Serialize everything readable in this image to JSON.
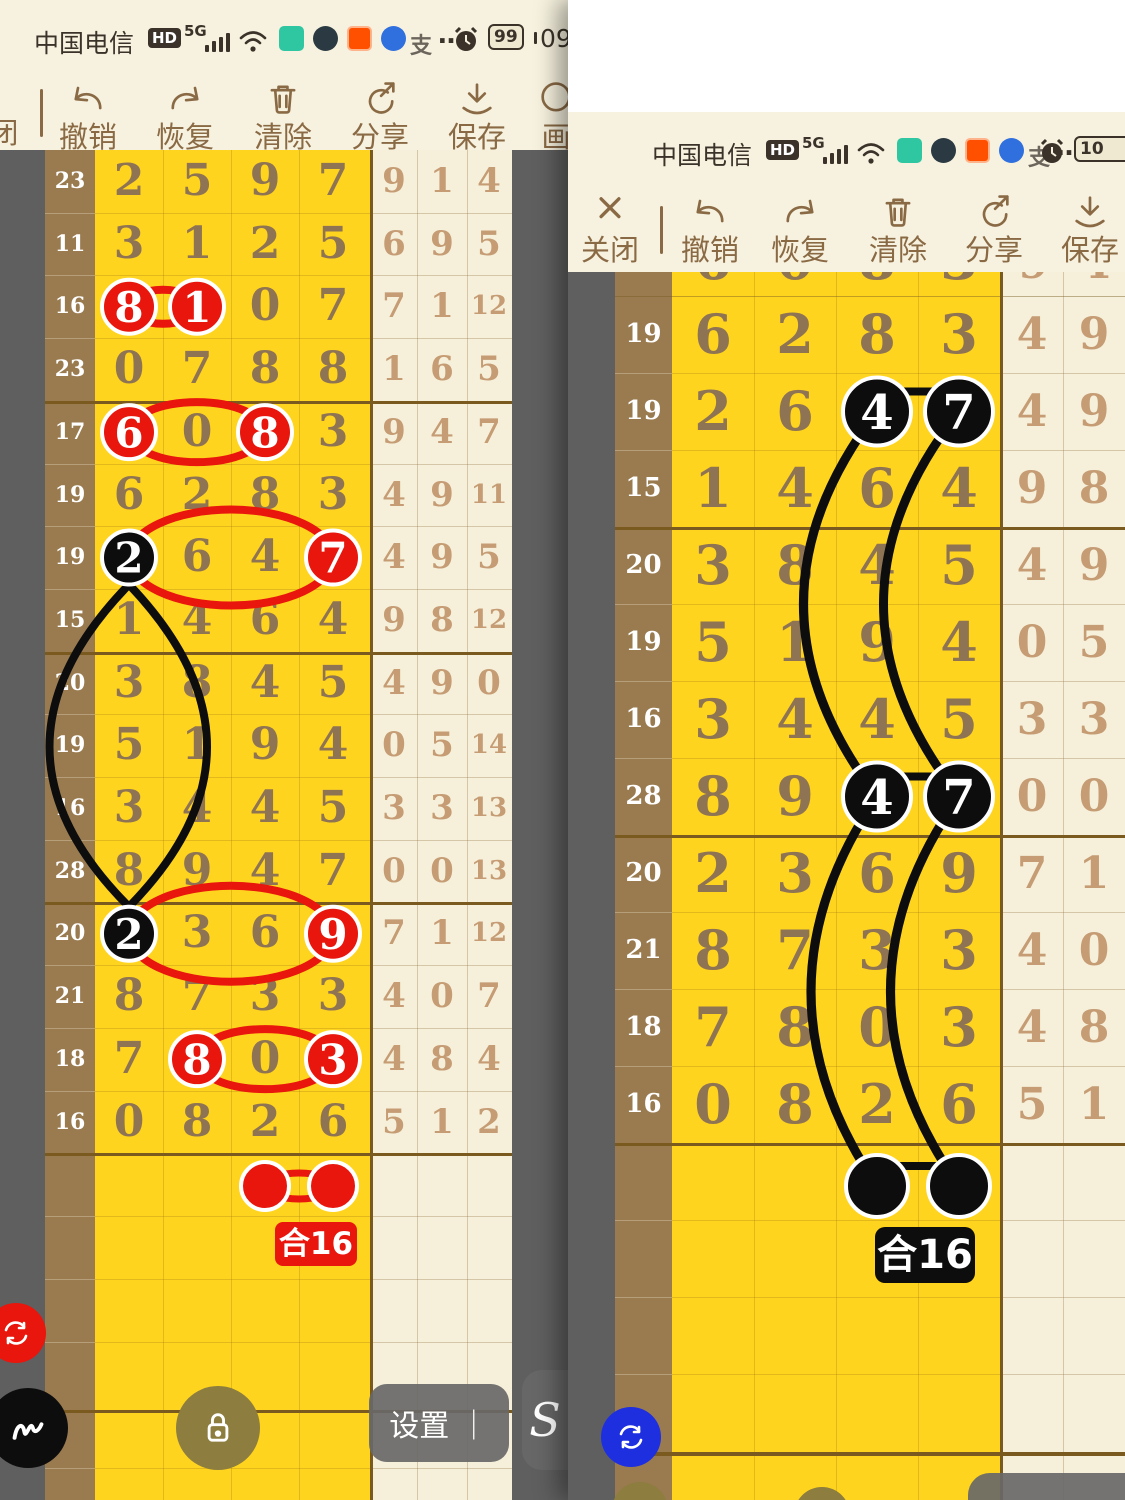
{
  "left_panel": {
    "status": {
      "carrier": "中国电信",
      "hd": "HD",
      "net": "5G",
      "alipay": "支",
      "more": "…",
      "battery": "99",
      "time": "09:"
    },
    "toolbar": {
      "close": "闭",
      "undo": "撤销",
      "redo": "恢复",
      "clear": "清除",
      "share": "分享",
      "save": "保存",
      "draw": "画"
    },
    "chart": {
      "row_labels": [
        "23",
        "11",
        "16",
        "23",
        "17",
        "19",
        "19",
        "15",
        "20",
        "19",
        "16",
        "28",
        "20",
        "21",
        "18",
        "16"
      ],
      "main_digits": [
        [
          "2",
          "5",
          "9",
          "7"
        ],
        [
          "3",
          "1",
          "2",
          "5"
        ],
        [
          "8",
          "1",
          "0",
          "7"
        ],
        [
          "0",
          "7",
          "8",
          "8"
        ],
        [
          "6",
          "0",
          "8",
          "3"
        ],
        [
          "6",
          "2",
          "8",
          "3"
        ],
        [
          "2",
          "6",
          "4",
          "7"
        ],
        [
          "1",
          "4",
          "6",
          "4"
        ],
        [
          "3",
          "8",
          "4",
          "5"
        ],
        [
          "5",
          "1",
          "9",
          "4"
        ],
        [
          "3",
          "4",
          "4",
          "5"
        ],
        [
          "8",
          "9",
          "4",
          "7"
        ],
        [
          "2",
          "3",
          "6",
          "9"
        ],
        [
          "8",
          "7",
          "3",
          "3"
        ],
        [
          "7",
          "8",
          "0",
          "3"
        ],
        [
          "0",
          "8",
          "2",
          "6"
        ]
      ],
      "right_digits": [
        [
          "9",
          "1",
          "4"
        ],
        [
          "6",
          "9",
          "5"
        ],
        [
          "7",
          "1",
          "12"
        ],
        [
          "1",
          "6",
          "5"
        ],
        [
          "9",
          "4",
          "7"
        ],
        [
          "4",
          "9",
          "11"
        ],
        [
          "4",
          "9",
          "5"
        ],
        [
          "9",
          "8",
          "12"
        ],
        [
          "4",
          "9",
          "0"
        ],
        [
          "0",
          "5",
          "14"
        ],
        [
          "3",
          "3",
          "13"
        ],
        [
          "0",
          "0",
          "13"
        ],
        [
          "7",
          "1",
          "12"
        ],
        [
          "4",
          "0",
          "7"
        ],
        [
          "4",
          "8",
          "4"
        ],
        [
          "5",
          "1",
          "2"
        ]
      ],
      "red_circles": [
        {
          "row": 2,
          "col": 0,
          "digit": "8"
        },
        {
          "row": 2,
          "col": 1,
          "digit": "1"
        },
        {
          "row": 4,
          "col": 0,
          "digit": "6"
        },
        {
          "row": 4,
          "col": 2,
          "digit": "8"
        },
        {
          "row": 6,
          "col": 3,
          "digit": "7"
        },
        {
          "row": 12,
          "col": 3,
          "digit": "9"
        },
        {
          "row": 14,
          "col": 1,
          "digit": "8"
        },
        {
          "row": 14,
          "col": 3,
          "digit": "3"
        }
      ],
      "black_circles": [
        {
          "row": 6,
          "col": 0,
          "digit": "2"
        },
        {
          "row": 12,
          "col": 0,
          "digit": "2"
        }
      ],
      "red_links": [
        {
          "row": 2,
          "c1": 0,
          "c2": 1
        },
        {
          "row": 4,
          "c1": 0,
          "c2": 2
        },
        {
          "row": 6,
          "c1": 0,
          "c2": 3
        },
        {
          "row": 12,
          "c1": 0,
          "c2": 3
        },
        {
          "row": 14,
          "c1": 1,
          "c2": 3
        }
      ],
      "black_link": {
        "col": 0,
        "r1": 6,
        "r2": 12
      },
      "prediction": {
        "cols": [
          2,
          3
        ],
        "sum_label": "合16"
      }
    },
    "fabs": {
      "settings": "设置 ｜",
      "pen_s": "S"
    }
  },
  "right_panel": {
    "status": {
      "carrier": "中国电信",
      "hd": "HD",
      "net": "5G",
      "alipay": "支",
      "more": "…",
      "battery": "10"
    },
    "toolbar": {
      "close": "关闭",
      "undo": "撤销",
      "redo": "恢复",
      "clear": "清除",
      "share": "分享",
      "save": "保存"
    },
    "chart": {
      "partial_top": {
        "main": [
          "6",
          "0",
          "8",
          "3"
        ],
        "right": [
          "9",
          "4"
        ]
      },
      "row_labels": [
        "19",
        "19",
        "15",
        "20",
        "19",
        "16",
        "28",
        "20",
        "21",
        "18",
        "16"
      ],
      "main_digits": [
        [
          "6",
          "2",
          "8",
          "3"
        ],
        [
          "2",
          "6",
          "4",
          "7"
        ],
        [
          "1",
          "4",
          "6",
          "4"
        ],
        [
          "3",
          "8",
          "4",
          "5"
        ],
        [
          "5",
          "1",
          "9",
          "4"
        ],
        [
          "3",
          "4",
          "4",
          "5"
        ],
        [
          "8",
          "9",
          "4",
          "7"
        ],
        [
          "2",
          "3",
          "6",
          "9"
        ],
        [
          "8",
          "7",
          "3",
          "3"
        ],
        [
          "7",
          "8",
          "0",
          "3"
        ],
        [
          "0",
          "8",
          "2",
          "6"
        ]
      ],
      "right_digits": [
        [
          "4",
          "9"
        ],
        [
          "4",
          "9"
        ],
        [
          "9",
          "8"
        ],
        [
          "4",
          "9"
        ],
        [
          "0",
          "5"
        ],
        [
          "3",
          "3"
        ],
        [
          "0",
          "0"
        ],
        [
          "7",
          "1"
        ],
        [
          "4",
          "0"
        ],
        [
          "4",
          "8"
        ],
        [
          "5",
          "1"
        ]
      ],
      "black_circles": [
        {
          "row": 1,
          "col": 2,
          "digit": "4"
        },
        {
          "row": 1,
          "col": 3,
          "digit": "7"
        },
        {
          "row": 6,
          "col": 2,
          "digit": "4"
        },
        {
          "row": 6,
          "col": 3,
          "digit": "7"
        }
      ],
      "black_h_links": [
        {
          "row": 1,
          "c1": 2,
          "c2": 3
        },
        {
          "row": 6,
          "c1": 2,
          "c2": 3
        }
      ],
      "black_arcs": [
        {
          "from_row": 1,
          "to_row": 6,
          "col": 2
        },
        {
          "from_row": 1,
          "to_row": 6,
          "col": 3
        },
        {
          "from_row": 6,
          "to_pred": 0,
          "col": 2
        },
        {
          "from_row": 6,
          "to_pred": 1,
          "col": 3
        }
      ],
      "prediction": {
        "cols": [
          2,
          3
        ],
        "sum_label": "合16"
      }
    }
  },
  "colors": {
    "yellow": "#ffd41f",
    "cream": "#f6f0da",
    "label_brown": "#9a7b50",
    "panel_cream": "#f7f2df",
    "gray_bg": "#5f5f5f",
    "thick_line": "#7a5a1e",
    "red": "#e8160c",
    "black": "#0d0d0d",
    "digit_yellow_area": "#8f7453",
    "digit_cream_area": "#c59c74",
    "toolbar_brown": "#8a6a45",
    "fab_blue": "#1e2fe0",
    "fab_olive": "#8d7d3e"
  }
}
